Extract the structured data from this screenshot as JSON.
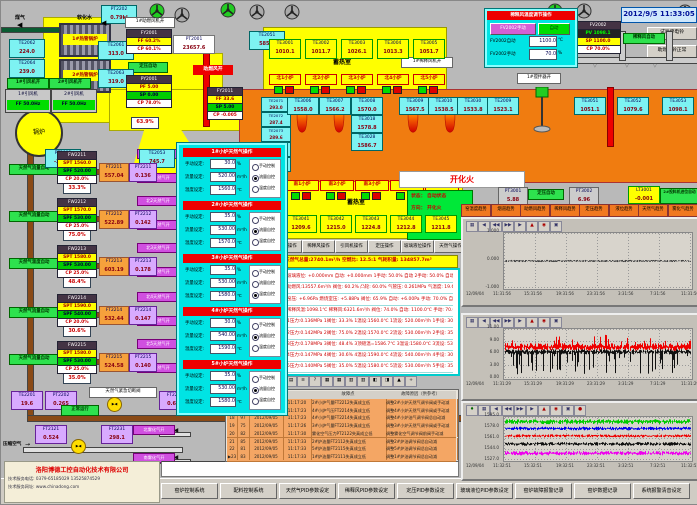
{
  "window": {
    "clock": "2012/9/5 11:33:05"
  },
  "top_left": {
    "gas_label": "煤气",
    "soft_water_label": "软化水",
    "pt2202_top": {
      "tag": "PT2202",
      "value": "0.79kl"
    },
    "exchangers": [
      "1#热管锅炉",
      "2#热管锅炉"
    ],
    "sensors": [
      {
        "tag": "TE2062",
        "value": "224.0"
      },
      {
        "tag": "TE2061",
        "value": "313.0"
      },
      {
        "tag": "TE2064",
        "value": "239.0"
      },
      {
        "tag": "TE2063",
        "value": "319.0"
      },
      {
        "tag": "TE2051",
        "value": "585.0"
      },
      {
        "tag": "PT2003",
        "value": "-220.1"
      },
      {
        "tag": "TE2053",
        "value": "745.7"
      }
    ],
    "fan_status": [
      "1#引风机开",
      "2#引风机开"
    ],
    "fan_units": [
      {
        "name": "1#引风机",
        "value": "FF 50.0Hz"
      },
      {
        "name": "2#引风机",
        "value": "FF 50.0Hz"
      }
    ],
    "boiler_label": "锅炉",
    "fy2001": {
      "title": "FY2001",
      "rows": [
        {
          "k": "FF",
          "v": "60.2%"
        },
        {
          "k": "CP",
          "v": "60.1%"
        }
      ]
    },
    "pt2001": {
      "tag": "PT2001",
      "value": "23657.6"
    },
    "pressure_auto": "定压自动",
    "py2001": {
      "title": "PY2001",
      "rows": [
        {
          "k": "PF",
          "v": "5.00"
        },
        {
          "k": "SP",
          "v": "0.00"
        },
        {
          "k": "CP",
          "v": "78.0%"
        }
      ]
    },
    "damper_value": "63.9%",
    "combustion_air_open": "助燃风开",
    "fan1_open": "1#助燃风机开",
    "fy2011": {
      "title": "FY2011",
      "rows": [
        {
          "k": "FF",
          "v": "33.6"
        },
        {
          "k": "SP",
          "v": "5.00"
        },
        {
          "k": "CP",
          "v": "-0.005"
        }
      ]
    }
  },
  "furnace": {
    "north_te": [
      {
        "tag": "TE3001",
        "value": "1010.1"
      },
      {
        "tag": "TE3002",
        "value": "1011.7"
      },
      {
        "tag": "TE3003",
        "value": "1026.1"
      },
      {
        "tag": "TE3004",
        "value": "1013.3"
      },
      {
        "tag": "TE3005",
        "value": "1051.7"
      }
    ],
    "north_ports": [
      "北1小炉",
      "北2小炉",
      "北3小炉",
      "北4小炉",
      "北5小炉"
    ],
    "regen_label": "蓄热室",
    "south_regen_label": "蓄热室",
    "left_te": [
      {
        "tag": "TE2071",
        "value": "293.0"
      },
      {
        "tag": "TE2072",
        "value": "287.4"
      },
      {
        "tag": "TE2073",
        "value": "289.6"
      },
      {
        "tag": "TE2074",
        "value": "288.1"
      },
      {
        "tag": "TE2075",
        "value": "290.3"
      }
    ],
    "crown_te": [
      {
        "tag": "TE3006",
        "value": "1558.0"
      },
      {
        "tag": "TE3007",
        "value": "1566.2"
      },
      {
        "tag": "TE3008",
        "value": "1570.0"
      },
      {
        "tag": "TE3018",
        "value": "1578.8"
      },
      {
        "tag": "TE3028",
        "value": "1586.7"
      },
      {
        "tag": "TE3009",
        "value": "1567.5"
      },
      {
        "tag": "TE3010",
        "value": "1538.5"
      },
      {
        "tag": "TE3030",
        "value": "1533.8"
      },
      {
        "tag": "TE2009",
        "value": "1523.1"
      },
      {
        "tag": "TE3051",
        "value": "1051.1"
      },
      {
        "tag": "TE3052",
        "value": "1079.6"
      },
      {
        "tag": "TE3053",
        "value": "1098.1"
      }
    ],
    "south_ports": [
      "南1小炉",
      "南2小炉",
      "南3小炉",
      "南4小炉",
      "南5小炉"
    ],
    "south_te": [
      {
        "tag": "TE3041",
        "value": "1209.6"
      },
      {
        "tag": "TE3042",
        "value": "1215.0"
      },
      {
        "tag": "TE3043",
        "value": "1224.8"
      },
      {
        "tag": "TE3044",
        "value": "1212.8"
      },
      {
        "tag": "TE3045",
        "value": "1211.8"
      }
    ],
    "dilution_fan_open": "1#稀释风机开",
    "fan2_open": "2#助燃风机开",
    "stirrer_open": "1#搅拌器开"
  },
  "fire_status": {
    "banner": "开化火",
    "rows": [
      "状态： 自动状态",
      "方向： 开化火",
      "总计： 1175 秒",
      "计时： 260 秒"
    ]
  },
  "ops_buttons": [
    "助燃风操作",
    "稀释风操作",
    "引风机操作",
    "定压操作",
    "玻璃液位操作",
    "天然气操作"
  ],
  "totals_bar": "天然气总量:2740.1m³/h  空燃比: 12.5:1  气耗积量: 134857.7m³",
  "param_rows": [
    "玻璃液位: +0.000mm  自动: +0.000mm  1手动: 50.0% 自动  2手动: 50.0% 自动",
    "助燃风:13557.6m³/h  阀位: 60.2%  凸轮: 60.0%  气管压: 0.261MPa  气温度: 19.6℃",
    "窑压: +6.96Pa  燃烧室压: +5.88Pa  阀位: 65.9%  自动: +6.00Pa  手动: 70.0% 自动",
    "稀释风温:1098.1℃  稀释风:6321.6m³/h  阀位: 74.0%  自动: 1100.0℃  手动: 70.0% 自动",
    "1压力:0.136MPa 1阀位: 33.3%  1温设:1560.0℃ 1流设: 520.00m³/h 1手设: 30.0%",
    "2压力:0.142MPa 2阀位: 75.0%  2温设:1570.0℃ 2流设: 530.00m³/h 2手设: 35.0%",
    "3压力:0.178MPa 3阀位: 48.4%  3顶碹温=1586.7℃ 3温设:1580.0℃ 3流设: 530.00m³/h 3手设: 35.0%",
    "4压力:0.147MPa 4阀位: 30.6%  4温设:1590.0℃ 4流设: 540.00m³/h 4手设: 30.0%",
    "5压力:0.140MPa 5阀位: 35.0%  5温设:1580.0℃ 5流设: 530.00m³/h 5手设: 35.0%"
  ],
  "gas_trains": [
    {
      "name": "FW2211",
      "mode": "天然气流量自动",
      "spt": "1560.0",
      "spf": "520.00",
      "cp": "20.0%",
      "out": "33.3%",
      "ft_tag": "FT2211",
      "ft": "557.04",
      "pt_tag": "PT2211",
      "pt": "0.136",
      "north": "北1天然气开",
      "south": "南1天然气开"
    },
    {
      "name": "FW2212",
      "mode": "天然气流量自动",
      "spt": "1570.0",
      "spf": "530.00",
      "cp": "25.0%",
      "out": "75.0%",
      "ft_tag": "FT2212",
      "ft": "522.89",
      "pt_tag": "PT2212",
      "pt": "0.142",
      "north": "北2天然气开",
      "south": "南2天然气开"
    },
    {
      "name": "FW2213",
      "mode": "天然气温度自动",
      "spt": "1580.0",
      "spf": "530.00",
      "cp": "25.0%",
      "out": "48.4%",
      "ft_tag": "FT2213",
      "ft": "603.19",
      "pt_tag": "PT2213",
      "pt": "0.178",
      "north": "北3天然气开",
      "south": "南3天然气开"
    },
    {
      "name": "FW2214",
      "mode": "天然气流量自动",
      "spt": "1590.0",
      "spf": "540.00",
      "cp": "20.0%",
      "out": "30.6%",
      "ft_tag": "FT2214",
      "ft": "532.44",
      "pt_tag": "PT2214",
      "pt": "0.147",
      "north": "北4天然气开",
      "south": "南4天然气开"
    },
    {
      "name": "FW2215",
      "mode": "天然气流量自动",
      "spt": "1580.0",
      "spf": "530.00",
      "cp": "25.0%",
      "out": "35.0%",
      "ft_tag": "FT2215",
      "ft": "524.58",
      "pt_tag": "PT2215",
      "pt": "0.140",
      "north": "北5天然气开",
      "south": "南5天然气开"
    }
  ],
  "gas_header": {
    "te2201": {
      "tag": "TE2201",
      "value": "19.6"
    },
    "pt2202": {
      "tag": "PT2202",
      "value": "0.265"
    },
    "status": "正常运行",
    "valve_label": "天然气紧急切断阀",
    "ft2201": {
      "tag": "FT2201",
      "value": "0.619"
    }
  },
  "air_line": {
    "label": "压缩空气",
    "ft2121": {
      "tag": "FT2121",
      "value": "0.524"
    },
    "ft2231": {
      "tag": "FT2231",
      "value": "298.1"
    },
    "north": "北雾化气开",
    "south": "南雾化气开"
  },
  "popup": {
    "labels": {
      "manual": "手动设定:",
      "flow": "流量设定:",
      "temp": "温度设定:",
      "u_manual": "%",
      "u_flow": "m³/h",
      "u_temp": "℃",
      "radios": [
        "手动控制",
        "流量自控",
        "温度自控"
      ]
    },
    "panels": [
      {
        "title": "1#小炉天然气操作",
        "manual": "30.0",
        "flow": "520.00",
        "temp": "1560.0",
        "mode": 1
      },
      {
        "title": "2#小炉天然气操作",
        "manual": "35.0",
        "flow": "530.00",
        "temp": "1570.0",
        "mode": 1
      },
      {
        "title": "3#小炉天然气操作",
        "manual": "35.0",
        "flow": "530.00",
        "temp": "1580.0",
        "mode": 2
      },
      {
        "title": "4#小炉天然气操作",
        "manual": "30.0",
        "flow": "540.00",
        "temp": "1590.0",
        "mode": 1
      },
      {
        "title": "5#小炉天然气操作",
        "manual": "35.0",
        "flow": "530.00",
        "temp": "1580.0",
        "mode": 1
      }
    ]
  },
  "dilution": {
    "title": "稀释风温度调节操作",
    "manual_btn": "FV2002手动",
    "auto_btn": "自动",
    "auto_label": "FV2002自动",
    "auto_value": "1100.0",
    "auto_unit": "℃",
    "manual_label": "FV2002手动",
    "manual_value": "70.0",
    "manual_unit": "%",
    "pos_value": "74.0%",
    "fv2002": {
      "title": "FV2002",
      "pv_k": "PV",
      "pv": "1098.1",
      "sp_k": "SP",
      "sp": "1100.0",
      "cp_k": "CP",
      "cp": "70.0%"
    },
    "pt2002": {
      "tag": "PT2002",
      "value": "6321.6"
    },
    "auto_tag": "稀释风自动",
    "bells": [
      "试验停电铃",
      "助燃电铃正常"
    ]
  },
  "right_top": {
    "pt3001": {
      "tag": "PT3001",
      "value": "5.88"
    },
    "auto1": "定压自动",
    "pt3002": {
      "tag": "PT3002",
      "value": "6.96"
    },
    "lt3001": {
      "tag": "LT3001",
      "value": "-0.001"
    },
    "auto2": "2#投料机进位自动"
  },
  "trend_buttons": [
    "窑温度趋势",
    "烟道趋势",
    "助燃风趋势",
    "稀释风趋势",
    "定压趋势",
    "液位趋势",
    "天然气趋势",
    "雾化气趋势"
  ],
  "chart_data": [
    {
      "type": "line",
      "title": "玻璃液位趋势",
      "ylim": [
        -1,
        1
      ],
      "ytick_labels": [
        "1.000",
        "0.000",
        "-1.000"
      ],
      "date": "12/09/04",
      "xticks": [
        "11:31:56",
        "15:31:56",
        "19:31:56",
        "23:31:56",
        "3:31:56",
        "7:31:56",
        "11:31:56"
      ],
      "series": [
        {
          "name": "玻璃液位",
          "color": "#444444",
          "base": 0.0,
          "amp": 0.04,
          "spike_prob": 0,
          "spike": 0
        }
      ]
    },
    {
      "type": "line",
      "title": "窑压趋势",
      "ylim": [
        0,
        11
      ],
      "ytick_labels": [
        "11.00",
        "9.00",
        "6.00",
        "3.00",
        "0.00"
      ],
      "date": "12/09/04",
      "xticks": [
        "11:31:29",
        "15:31:29",
        "19:31:29",
        "23:31:29",
        "3:31:29",
        "7:31:29",
        "11:31:29"
      ],
      "series": [
        {
          "name": "燃烧室压",
          "color": "#ee0000",
          "base": 7.1,
          "amp": 0.9,
          "spike_prob": 0.12,
          "spike": 2.2
        },
        {
          "name": "窑压",
          "color": "#111111",
          "base": 6.0,
          "amp": 0.6,
          "spike_prob": 0.3,
          "spike": -4.8
        }
      ]
    },
    {
      "type": "line",
      "title": "窑温度趋势",
      "ylim": [
        1527,
        1595
      ],
      "ytick_labels": [
        "1595.0",
        "1578.0",
        "1561.0",
        "1544.0",
        "1527.0"
      ],
      "date": "12/09/04",
      "xticks": [
        "11:32:51",
        "15:32:51",
        "19:32:51",
        "23:32:51",
        "3:32:51",
        "7:32:51",
        "11:32:51"
      ],
      "series": [
        {
          "name": "1#温度",
          "color": "#00cc00",
          "base": 1589,
          "amp": 4,
          "spike_prob": 0,
          "spike": 0
        },
        {
          "name": "2#温度",
          "color": "#0000ee",
          "base": 1578,
          "amp": 3,
          "spike_prob": 0,
          "spike": 0
        },
        {
          "name": "3#温度",
          "color": "#ee0000",
          "base": 1566,
          "amp": 2.5,
          "spike_prob": 0,
          "spike": 0
        },
        {
          "name": "4#温度",
          "color": "#111111",
          "base": 1553,
          "amp": 3,
          "spike_prob": 0,
          "spike": 0
        },
        {
          "name": "5#温度",
          "color": "#ee00ee",
          "base": 1538,
          "amp": 3.5,
          "spike_prob": 0,
          "spike": 0
        }
      ]
    }
  ],
  "alarm_table": {
    "headers": [
      "故障点",
      "故障原因（供参考）"
    ],
    "rows": [
      [
        "16",
        "90",
        "2012/09/05",
        "11:17:20",
        "2#小炉气量FT2212失真成立低",
        "调整2#小炉天然气调节阀或手动减"
      ],
      [
        "17",
        "84",
        "2012/09/05",
        "11:17:23",
        "4#小炉气压FT2214失真成立低",
        "调整4#小炉天然气调节阀或手动减"
      ],
      [
        "18",
        "97",
        "2012/09/05",
        "11:17:23",
        "4#小炉气量FT2214失真成立低",
        "调整4#小炉油气调节阀总自动减"
      ],
      [
        "19",
        "75",
        "2012/09/05",
        "11:17:26",
        "3#小炉气量FT2213失真成立低",
        "调整3#小炉天然气调节阀或手动减"
      ],
      [
        "20",
        "82",
        "2012/09/05",
        "11:17:30",
        "雾化空气压力PT2122失真成立低",
        "调整雾化空气调节阀前阀手动减"
      ],
      [
        "21",
        "85",
        "2012/09/05",
        "11:17:33",
        "2#炉油量FT2112失真成立低",
        "调整2#炉油调节阀总自动减"
      ],
      [
        "22",
        "81",
        "2012/09/05",
        "11:17:33",
        "5#炉油量FT2115失真成立低",
        "调整5#炉油调节阀总自动减"
      ],
      [
        "23",
        "83",
        "2012/09/05",
        "11:17:33",
        "1#炉油量FT2111失真成立低",
        "调整1#炉油调节阀总自动减"
      ]
    ]
  },
  "bottom_buttons": [
    "窑炉控制系统",
    "配料控制系统",
    "天然气PID参数设定",
    "稀释风PID参数设定",
    "定压PID参数设定",
    "玻璃液位PID参数设定",
    "窑炉故障报警记录",
    "窑炉数据记录",
    "系统报警清音设定"
  ],
  "company": {
    "name": "洛阳博德工控自动化技术有限公司",
    "tel": "技术服务电话: 0379-65185029  13525874529",
    "web": "技术服务网址: www.chinadong.com"
  }
}
